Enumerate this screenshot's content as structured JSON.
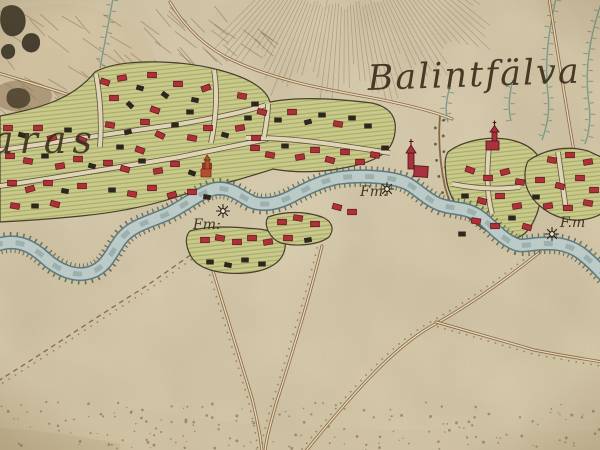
{
  "map": {
    "style": "18th-century hand-drawn military survey map sheet",
    "labels": {
      "village_name_right": "Balintfälva",
      "village_name_left_partial": "aras",
      "mill_1": "Fm:",
      "mill_2": "Fm.",
      "mill_3": "F.m"
    },
    "symbols": {
      "mill_wheel_count": 3,
      "church_count": 3,
      "house_symbol_colors": [
        "red",
        "black"
      ]
    },
    "colors": {
      "parchment": "#e3d6b6",
      "river_fill": "#bccbc7",
      "river_edge": "#5c7a80",
      "plot_green": "#c9c98c",
      "plot_hatch": "#99a055",
      "house_red": "#ae3038",
      "house_black": "#2c261c",
      "road_brown": "#8a6744",
      "stream_teal": "#7d9a8c",
      "ink": "#3b2f1d",
      "bottom_wash": "#cdc0a0"
    },
    "houses": [
      [
        105,
        82,
        20,
        "r"
      ],
      [
        122,
        78,
        -10,
        "r"
      ],
      [
        140,
        88,
        15,
        "b"
      ],
      [
        152,
        75,
        0,
        "r"
      ],
      [
        165,
        95,
        35,
        "b"
      ],
      [
        178,
        84,
        0,
        "r"
      ],
      [
        195,
        100,
        10,
        "b"
      ],
      [
        206,
        88,
        -20,
        "r"
      ],
      [
        130,
        105,
        45,
        "b"
      ],
      [
        114,
        98,
        0,
        "r"
      ],
      [
        155,
        110,
        20,
        "r"
      ],
      [
        190,
        112,
        0,
        "b"
      ],
      [
        242,
        96,
        10,
        "r"
      ],
      [
        255,
        104,
        0,
        "b"
      ],
      [
        110,
        125,
        10,
        "r"
      ],
      [
        128,
        132,
        -15,
        "b"
      ],
      [
        145,
        122,
        0,
        "r"
      ],
      [
        160,
        135,
        25,
        "r"
      ],
      [
        175,
        125,
        0,
        "b"
      ],
      [
        192,
        138,
        10,
        "r"
      ],
      [
        208,
        128,
        0,
        "r"
      ],
      [
        225,
        135,
        15,
        "b"
      ],
      [
        240,
        128,
        -10,
        "r"
      ],
      [
        256,
        138,
        0,
        "r"
      ],
      [
        120,
        147,
        0,
        "b"
      ],
      [
        140,
        150,
        20,
        "r"
      ],
      [
        8,
        128,
        0,
        "r"
      ],
      [
        22,
        135,
        15,
        "b"
      ],
      [
        38,
        128,
        0,
        "r"
      ],
      [
        52,
        138,
        -15,
        "r"
      ],
      [
        68,
        130,
        0,
        "b"
      ],
      [
        82,
        140,
        20,
        "r"
      ],
      [
        10,
        156,
        0,
        "r"
      ],
      [
        28,
        161,
        10,
        "r"
      ],
      [
        45,
        156,
        0,
        "b"
      ],
      [
        60,
        166,
        -10,
        "r"
      ],
      [
        78,
        159,
        0,
        "r"
      ],
      [
        92,
        166,
        15,
        "b"
      ],
      [
        12,
        183,
        0,
        "r"
      ],
      [
        30,
        189,
        -15,
        "r"
      ],
      [
        48,
        183,
        0,
        "r"
      ],
      [
        65,
        191,
        10,
        "b"
      ],
      [
        82,
        186,
        0,
        "r"
      ],
      [
        15,
        206,
        10,
        "r"
      ],
      [
        35,
        206,
        0,
        "b"
      ],
      [
        55,
        204,
        15,
        "r"
      ],
      [
        108,
        163,
        0,
        "r"
      ],
      [
        125,
        169,
        15,
        "r"
      ],
      [
        142,
        161,
        0,
        "b"
      ],
      [
        158,
        171,
        -10,
        "r"
      ],
      [
        175,
        164,
        0,
        "r"
      ],
      [
        192,
        173,
        20,
        "b"
      ],
      [
        207,
        166,
        0,
        "r"
      ],
      [
        112,
        190,
        0,
        "b"
      ],
      [
        132,
        194,
        10,
        "r"
      ],
      [
        152,
        188,
        0,
        "r"
      ],
      [
        172,
        195,
        -15,
        "r"
      ],
      [
        192,
        192,
        0,
        "r"
      ],
      [
        207,
        197,
        10,
        "b"
      ],
      [
        248,
        118,
        0,
        "b"
      ],
      [
        262,
        112,
        15,
        "r"
      ],
      [
        278,
        120,
        0,
        "b"
      ],
      [
        292,
        112,
        0,
        "r"
      ],
      [
        308,
        122,
        -15,
        "b"
      ],
      [
        322,
        115,
        0,
        "b"
      ],
      [
        338,
        124,
        10,
        "r"
      ],
      [
        352,
        118,
        0,
        "b"
      ],
      [
        368,
        126,
        0,
        "b"
      ],
      [
        255,
        148,
        0,
        "r"
      ],
      [
        270,
        155,
        10,
        "r"
      ],
      [
        285,
        146,
        0,
        "b"
      ],
      [
        300,
        157,
        -10,
        "r"
      ],
      [
        315,
        150,
        0,
        "r"
      ],
      [
        330,
        160,
        15,
        "r"
      ],
      [
        345,
        152,
        0,
        "r"
      ],
      [
        360,
        162,
        0,
        "r"
      ],
      [
        375,
        155,
        10,
        "r"
      ],
      [
        385,
        148,
        0,
        "b"
      ],
      [
        205,
        240,
        0,
        "r"
      ],
      [
        220,
        238,
        10,
        "r"
      ],
      [
        237,
        242,
        0,
        "r"
      ],
      [
        252,
        238,
        0,
        "r"
      ],
      [
        268,
        242,
        -10,
        "r"
      ],
      [
        210,
        262,
        0,
        "b"
      ],
      [
        228,
        265,
        10,
        "b"
      ],
      [
        245,
        260,
        0,
        "b"
      ],
      [
        262,
        264,
        0,
        "b"
      ],
      [
        282,
        222,
        0,
        "r"
      ],
      [
        298,
        218,
        10,
        "r"
      ],
      [
        315,
        224,
        0,
        "r"
      ],
      [
        288,
        238,
        0,
        "r"
      ],
      [
        308,
        240,
        -10,
        "b"
      ],
      [
        337,
        207,
        15,
        "r"
      ],
      [
        352,
        212,
        0,
        "r"
      ],
      [
        470,
        170,
        20,
        "r"
      ],
      [
        488,
        178,
        0,
        "r"
      ],
      [
        505,
        172,
        -15,
        "r"
      ],
      [
        520,
        182,
        10,
        "r"
      ],
      [
        465,
        196,
        0,
        "b"
      ],
      [
        482,
        201,
        15,
        "r"
      ],
      [
        500,
        196,
        0,
        "r"
      ],
      [
        517,
        206,
        -10,
        "r"
      ],
      [
        476,
        221,
        10,
        "r"
      ],
      [
        495,
        226,
        0,
        "r"
      ],
      [
        512,
        218,
        0,
        "b"
      ],
      [
        527,
        227,
        15,
        "r"
      ],
      [
        462,
        234,
        0,
        "b"
      ],
      [
        552,
        160,
        10,
        "r"
      ],
      [
        570,
        155,
        0,
        "r"
      ],
      [
        588,
        162,
        -10,
        "r"
      ],
      [
        540,
        180,
        0,
        "r"
      ],
      [
        560,
        186,
        15,
        "r"
      ],
      [
        580,
        178,
        0,
        "r"
      ],
      [
        594,
        190,
        0,
        "r"
      ],
      [
        548,
        206,
        -10,
        "r"
      ],
      [
        568,
        208,
        0,
        "r"
      ],
      [
        588,
        203,
        10,
        "r"
      ],
      [
        536,
        197,
        0,
        "b"
      ]
    ]
  }
}
